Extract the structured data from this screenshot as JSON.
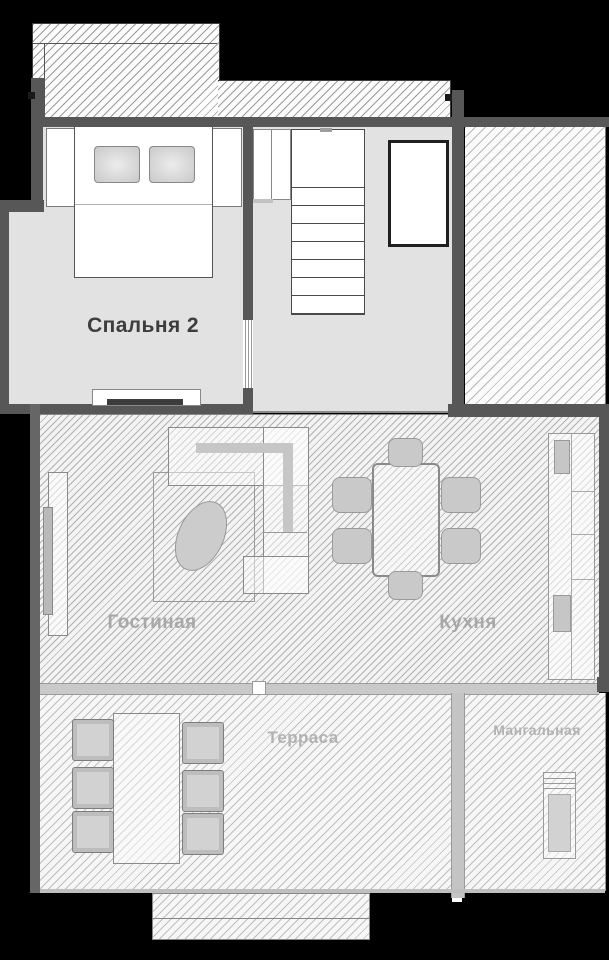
{
  "plan": {
    "title": "floor-plan-level-2",
    "rooms": {
      "bedroom2": {
        "label": "Спальня 2"
      },
      "living": {
        "label": "Гостиная"
      },
      "kitchen": {
        "label": "Кухня"
      },
      "terrace": {
        "label": "Терраса"
      },
      "bbq": {
        "label": "Мангальная"
      }
    },
    "colors": {
      "background": "#000000",
      "wall": "#575757",
      "wall_light": "#666666",
      "floor": "#e2e2e2",
      "divider": "#c9c9c9",
      "divider_light": "#c4c4c4",
      "furniture": "#c9c9c9",
      "chair_terrace": "#bdbdbd",
      "label_dark": "#3d3d3d",
      "label_gray": "#a8a8a8",
      "label_light": "#b2b2b2"
    }
  }
}
